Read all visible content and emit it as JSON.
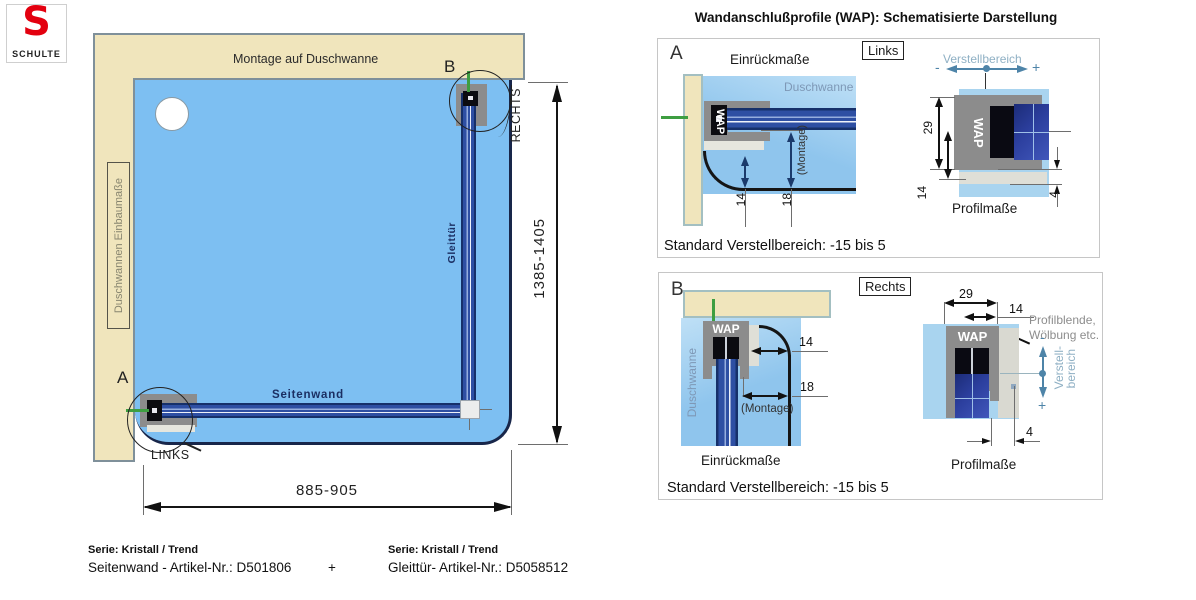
{
  "logo": {
    "letter": "S",
    "name": "SCHULTE"
  },
  "title": "Wandanschlußprofile (WAP): Schematisierte Darstellung",
  "main": {
    "top_wall": "Montage auf Duschwanne",
    "left_wall": "Duschwannen Einbaumaße",
    "marker_a": "A",
    "marker_b": "B",
    "links": "LINKS",
    "rechts": "RECHTS",
    "seitenwand": "Seitenwand",
    "gleittuer": "Gleittür",
    "dim_width": "885-905",
    "dim_height": "1385-1405"
  },
  "panel_a": {
    "marker": "A",
    "side": "Links",
    "einrueck": "Einrückmaße",
    "duschwanne": "Duschwanne",
    "wap": "WAP",
    "dim14": "14",
    "dim18": "18",
    "montage": "(Montage)",
    "verstellbereich": "Verstellbereich",
    "minus": "-",
    "plus": "+",
    "wap2": "WAP",
    "dim29": "29",
    "dim14b": "14",
    "dim4": "4",
    "profilmasse": "Profilmaße",
    "footer": "Standard Verstellbereich: -15 bis 5"
  },
  "panel_b": {
    "marker": "B",
    "side": "Rechts",
    "duschwanne": "Duschwanne",
    "wap": "WAP",
    "dim14": "14",
    "dim18": "18",
    "montage": "(Montage)",
    "einrueck": "Einrückmaße",
    "dim29": "29",
    "dim14b": "14",
    "profilblende_1": "Profilblende,",
    "profilblende_2": "Wölbung etc.",
    "wap2": "WAP",
    "verstell_1": "Verstell-",
    "verstell_2": "bereich",
    "minus": "-",
    "plus": "+",
    "dim4": "4",
    "profilmasse": "Profilmaße",
    "footer": "Standard Verstellbereich: -15 bis 5"
  },
  "footer": {
    "left_serie": "Serie: Kristall / Trend",
    "left_artikel": "Seitenwand - Artikel-Nr.: D501806",
    "plus": "+",
    "right_serie": "Serie: Kristall / Trend",
    "right_artikel": "Gleittür- Artikel-Nr.: D5058512"
  },
  "colors": {
    "wall_beige": "#f0e5bc",
    "wall_border": "#7f909a",
    "panel_wall_border": "#a3bfc1",
    "tray_blue": "#7dbff2",
    "tray_border": "#18264a",
    "profile_gray": "#8c8c8c",
    "bar_navy": "#2e4fa3",
    "green_marker": "#3e9e41",
    "steel_blue": "#4e84a8",
    "logo_red": "#e3000f"
  }
}
